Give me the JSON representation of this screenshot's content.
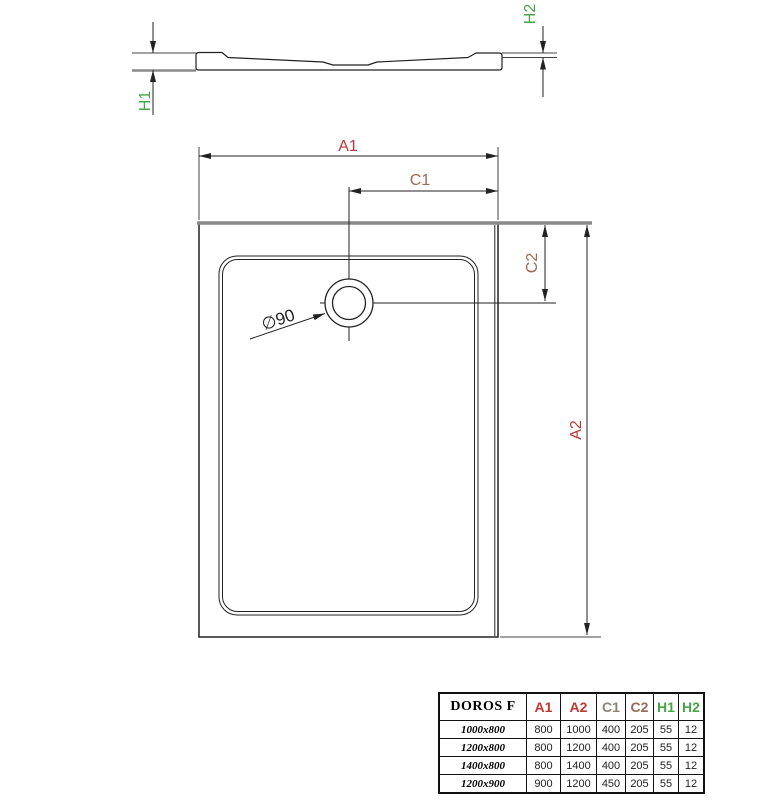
{
  "drawing": {
    "dimension_labels": {
      "a1": "A1",
      "a2": "A2",
      "c1": "C1",
      "c2": "C2",
      "h1": "H1",
      "h2": "H2"
    },
    "drain_diameter_label": "∅90"
  },
  "colors": {
    "line": "#222222",
    "edge_gray": "#8a8a8a",
    "dim_a": "#bf3733",
    "dim_c": "#9a6950",
    "dim_h": "#46a546"
  },
  "table": {
    "product_name": "DOROS F",
    "columns": [
      "A1",
      "A2",
      "C1",
      "C2",
      "H1",
      "H2"
    ],
    "rows": [
      {
        "size": "1000x800",
        "values": [
          "800",
          "1000",
          "400",
          "205",
          "55",
          "12"
        ]
      },
      {
        "size": "1200x800",
        "values": [
          "800",
          "1200",
          "400",
          "205",
          "55",
          "12"
        ]
      },
      {
        "size": "1400x800",
        "values": [
          "800",
          "1400",
          "400",
          "205",
          "55",
          "12"
        ]
      },
      {
        "size": "1200x900",
        "values": [
          "900",
          "1200",
          "450",
          "205",
          "55",
          "12"
        ]
      }
    ]
  }
}
